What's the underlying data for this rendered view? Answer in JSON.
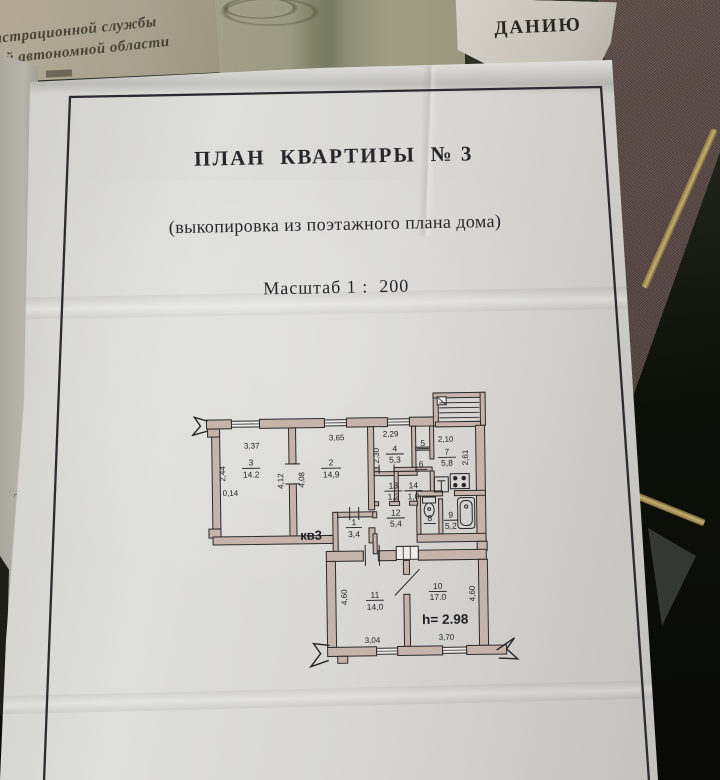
{
  "background": {
    "stamp_text_line1": "истрационной службы",
    "stamp_text_line2": "кой автономной области",
    "torn_fragment": "ДАНИЮ",
    "edge_marks": [
      "с",
      "№",
      "3"
    ]
  },
  "document": {
    "title": "ПЛАН  КВАРТИРЫ  № 3",
    "subtitle": "(выкопировка из поэтажного плана дома)",
    "scale_line": "Масштаб 1 :  200"
  },
  "plan": {
    "apartment_label": "кв3",
    "ceiling_height": "h= 2.98",
    "rooms": {
      "r1": {
        "num": "1",
        "area": "3,4"
      },
      "r2": {
        "num": "2",
        "area": "14,9"
      },
      "r3": {
        "num": "3",
        "area": "14.2"
      },
      "r4": {
        "num": "4",
        "area": "5,3"
      },
      "r5": {
        "num": "5",
        "area": ""
      },
      "r6": {
        "num": "6",
        "area": ""
      },
      "r7": {
        "num": "7",
        "area": "5,8"
      },
      "r8": {
        "num": "8",
        "area": ""
      },
      "r9": {
        "num": "9",
        "area": "5,2"
      },
      "r10": {
        "num": "10",
        "area": "17.0"
      },
      "r11": {
        "num": "11",
        "area": "14,0"
      },
      "r12": {
        "num": "12",
        "area": "5,4"
      },
      "r13": {
        "num": "13",
        "area": "1,2"
      },
      "r14": {
        "num": "14",
        "area": "1,0"
      }
    },
    "dims": {
      "d3_top": "3,37",
      "d3_left": "2,44",
      "d3_left_low": "0,14",
      "d3_right": "4,12",
      "d2_top": "3,65",
      "d2_left": "4,08",
      "d4_top": "2,29",
      "d4_left": "2,30",
      "d7_top": "2,10",
      "d7_right": "2,61",
      "d11_left": "4,60",
      "d11_bottom": "3,04",
      "d10_bottom": "3,70",
      "d10_right": "4,60"
    }
  }
}
